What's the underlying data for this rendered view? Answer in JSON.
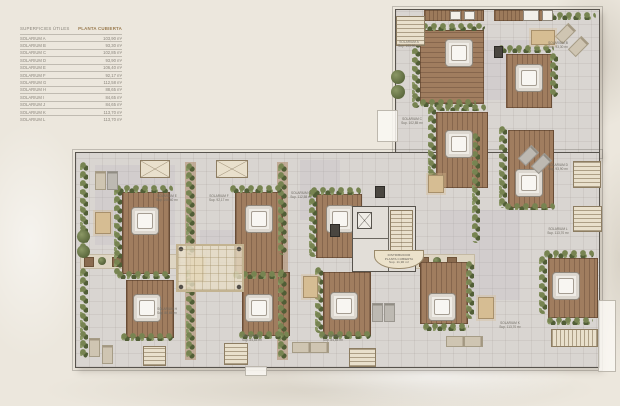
{
  "legend": {
    "title": "SUPERFICIES ÚTILES",
    "subtitle": "PLANTA CUBIERTA",
    "rows": [
      {
        "name": "SOLARIUM A",
        "value": "103,90 m²"
      },
      {
        "name": "SOLARIUM B",
        "value": "93,30 m²"
      },
      {
        "name": "SOLARIUM C",
        "value": "102,85 m²"
      },
      {
        "name": "SOLARIUM D",
        "value": "93,90 m²"
      },
      {
        "name": "SOLARIUM E",
        "value": "106,40 m²"
      },
      {
        "name": "SOLARIUM F",
        "value": "92,17 m²"
      },
      {
        "name": "SOLARIUM G",
        "value": "112,58 m²"
      },
      {
        "name": "SOLARIUM H",
        "value": "88,65 m²"
      },
      {
        "name": "SOLARIUM I",
        "value": "84,65 m²"
      },
      {
        "name": "SOLARIUM J",
        "value": "84,65 m²"
      },
      {
        "name": "SOLARIUM K",
        "value": "113,70 m²"
      },
      {
        "name": "SOLARIUM L",
        "value": "113,70 m²"
      }
    ]
  },
  "plan": {
    "core_label": {
      "line1": "DISTRIBUIDOR",
      "line2": "PLANTA CUBIERTA",
      "line3": "Sup. 11,90 m²"
    },
    "solarium_labels": [
      {
        "name": "SOLARIUM A",
        "sup": "Sup. 103,90 m²"
      },
      {
        "name": "SOLARIUM B",
        "sup": "Sup. 93,30 m²"
      },
      {
        "name": "SOLARIUM C",
        "sup": "Sup. 102,85 m²"
      },
      {
        "name": "SOLARIUM D",
        "sup": "Sup. 93,90 m²"
      },
      {
        "name": "SOLARIUM E",
        "sup": "Sup. 106,40 m²"
      },
      {
        "name": "SOLARIUM F",
        "sup": "Sup. 92,17 m²"
      },
      {
        "name": "SOLARIUM G",
        "sup": "Sup. 112,58 m²"
      },
      {
        "name": "SOLARIUM H",
        "sup": "Sup. 88,65 m²"
      },
      {
        "name": "SOLARIUM I",
        "sup": "Sup. 84,65 m²"
      },
      {
        "name": "SOLARIUM J",
        "sup": "Sup. 84,65 m²"
      },
      {
        "name": "SOLARIUM K",
        "sup": "Sup. 113,70 m²"
      },
      {
        "name": "SOLARIUM L",
        "sup": "Sup. 113,70 m²"
      }
    ],
    "colors": {
      "background": "#ece7dd",
      "wall": "#57534d",
      "floor": "#d9d5d1",
      "deck": "#a07d5f",
      "hedge": "#6f7c4b",
      "accent_subtitle": "#9a7b4f"
    }
  }
}
